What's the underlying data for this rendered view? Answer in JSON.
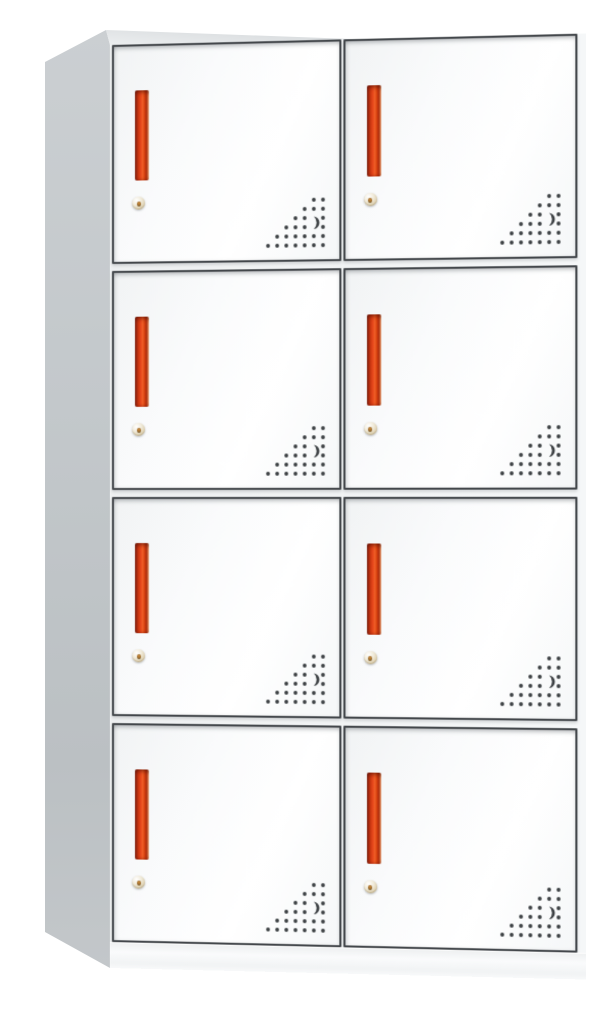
{
  "product": {
    "type": "metal locker storage cabinet",
    "rows": 4,
    "columns": 2,
    "door_count": 8
  },
  "door": {
    "handle": "red-vertical-recessed-handle",
    "lock": "round-key-lock",
    "vent": "triangular-perforation-with-crescent-cutout"
  },
  "colors": {
    "background": "#ffffff",
    "door_face": "#fbfcfd",
    "door_border": "#43474b",
    "handle_red": "#e8491c",
    "handle_red_dark": "#7e2110",
    "handle_highlight": "#f5cbae",
    "side_panel_gray": "#c3c8cb",
    "top_panel_gray": "#dfe2e4",
    "lock_brass": "#ddd0b0",
    "vent_dot": "#3c4043",
    "base_white": "#f8f9fa"
  }
}
